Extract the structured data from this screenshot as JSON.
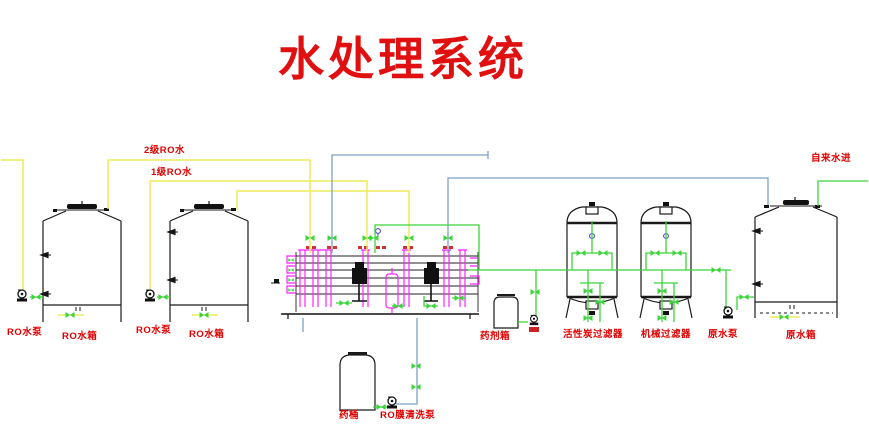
{
  "title": "水处理系统",
  "colors": {
    "title_red": "#e01010",
    "label_red": "#e00000",
    "pipe_yellow": "#ecec5a",
    "pipe_green": "#3bd43b",
    "pipe_cyan": "#7da1c4",
    "pipe_magenta": "#ff22ff",
    "line_black": "#1a1a1a"
  },
  "pipe_labels": {
    "stage2_ro": "2级RO水",
    "stage1_ro": "1级RO水",
    "tap_water_in": "自来水进"
  },
  "equipment": {
    "ro_pump_1": "RO水泵",
    "ro_tank_1": "RO水箱",
    "ro_pump_2": "RO水泵",
    "ro_tank_2": "RO水箱",
    "chem_barrel": "药桶",
    "ro_membrane_cleaning_pump": "RO膜清洗泵",
    "dosing_tank": "药剂箱",
    "activated_carbon_filter": "活性炭过滤器",
    "mechanical_filter": "机械过滤器",
    "raw_water_pump": "原水泵",
    "raw_water_tank": "原水箱"
  }
}
